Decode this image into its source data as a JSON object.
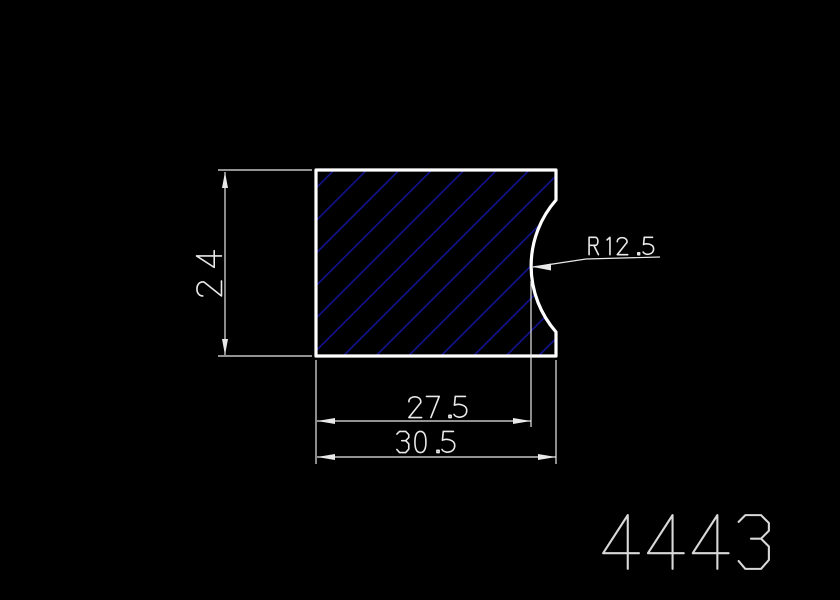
{
  "canvas": {
    "width": 840,
    "height": 600,
    "background": "#000000"
  },
  "drawing": {
    "shape": {
      "fill_color": "#000000",
      "outline_color": "#ffffff",
      "hatch": {
        "color": "#14149b",
        "angle_deg": 45,
        "spacing_px": 23
      }
    },
    "annotation_color": "#e9e9e9",
    "dimensions": {
      "height": {
        "label": "24"
      },
      "width_to_groove": {
        "label": "27.5"
      },
      "overall_width": {
        "label": "30.5"
      },
      "groove_radius": {
        "label": "R12.5"
      }
    },
    "part_number": {
      "label": "4443",
      "color": "#d8d8d8"
    }
  }
}
